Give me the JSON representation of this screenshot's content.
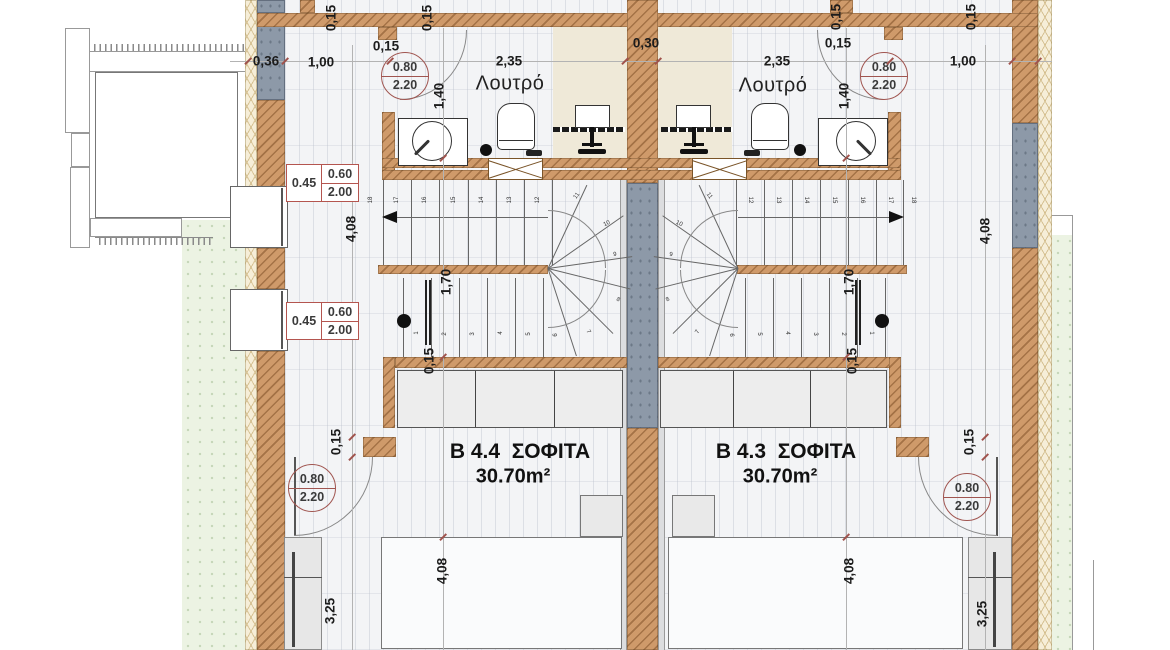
{
  "palette": {
    "wall_brown": "#cf9a6a",
    "wall_gray": "#8d99a8",
    "insulation": "#f6eed8",
    "floor": "#f3f4f6",
    "green": "#ecf3e3",
    "tag_red": "#a05550",
    "text": "#1c1c1c"
  },
  "rooms": [
    {
      "name": "B 4.4  ΣΟΦΙΤΑ",
      "area": "30.70m²"
    },
    {
      "name": "B 4.3  ΣΟΦΙΤΑ",
      "area": "30.70m²"
    }
  ],
  "bath_labels": [
    "Λουτρό",
    "Λουτρό"
  ],
  "dimensions": [
    {
      "text": "0,36",
      "x": 266,
      "y": 61,
      "rot": 0
    },
    {
      "text": "1,00",
      "x": 321,
      "y": 62,
      "rot": 0
    },
    {
      "text": "0,15",
      "x": 386,
      "y": 46,
      "rot": 0
    },
    {
      "text": "2,35",
      "x": 509,
      "y": 61,
      "rot": 0
    },
    {
      "text": "0,30",
      "x": 646,
      "y": 43,
      "rot": 0
    },
    {
      "text": "2,35",
      "x": 777,
      "y": 61,
      "rot": 0
    },
    {
      "text": "0,15",
      "x": 838,
      "y": 43,
      "rot": 0
    },
    {
      "text": "1,00",
      "x": 963,
      "y": 61,
      "rot": 0
    },
    {
      "text": "0,15",
      "x": 331,
      "y": 18,
      "rot": -90
    },
    {
      "text": "0,15",
      "x": 427,
      "y": 18,
      "rot": -90
    },
    {
      "text": "0,15",
      "x": 836,
      "y": 17,
      "rot": -90
    },
    {
      "text": "0,15",
      "x": 971,
      "y": 17,
      "rot": -90
    },
    {
      "text": "1,40",
      "x": 439,
      "y": 96,
      "rot": -90
    },
    {
      "text": "1,40",
      "x": 844,
      "y": 96,
      "rot": -90
    },
    {
      "text": "4,08",
      "x": 351,
      "y": 229,
      "rot": -90
    },
    {
      "text": "4,08",
      "x": 985,
      "y": 231,
      "rot": -90
    },
    {
      "text": "1,70",
      "x": 446,
      "y": 282,
      "rot": -90
    },
    {
      "text": "1,70",
      "x": 849,
      "y": 282,
      "rot": -90
    },
    {
      "text": "0,15",
      "x": 429,
      "y": 361,
      "rot": -90
    },
    {
      "text": "0,15",
      "x": 852,
      "y": 361,
      "rot": -90
    },
    {
      "text": "0,15",
      "x": 336,
      "y": 442,
      "rot": -90
    },
    {
      "text": "0,15",
      "x": 969,
      "y": 442,
      "rot": -90
    },
    {
      "text": "3,25",
      "x": 330,
      "y": 611,
      "rot": -90
    },
    {
      "text": "3,25",
      "x": 982,
      "y": 614,
      "rot": -90
    },
    {
      "text": "4,08",
      "x": 442,
      "y": 571,
      "rot": -90
    },
    {
      "text": "4,08",
      "x": 849,
      "y": 571,
      "rot": -90
    }
  ],
  "door_tags": [
    {
      "width": "0.80",
      "height": "2.20",
      "cx": 405,
      "cy": 76
    },
    {
      "width": "0.80",
      "height": "2.20",
      "cx": 884,
      "cy": 76
    },
    {
      "width": "0.80",
      "height": "2.20",
      "cx": 312,
      "cy": 488
    },
    {
      "width": "0.80",
      "height": "2.20",
      "cx": 967,
      "cy": 497
    }
  ],
  "window_tags": [
    {
      "sill": "0.45",
      "width": "0.60",
      "height": "2.00",
      "x": 286,
      "y": 164
    },
    {
      "sill": "0.45",
      "width": "0.60",
      "height": "2.00",
      "x": 286,
      "y": 302
    }
  ],
  "stair_numbers": [
    {
      "n": "18",
      "x": 371,
      "y": 200,
      "rot": -90
    },
    {
      "n": "17",
      "x": 397,
      "y": 200,
      "rot": -90
    },
    {
      "n": "16",
      "x": 425,
      "y": 200,
      "rot": -90
    },
    {
      "n": "15",
      "x": 454,
      "y": 200,
      "rot": -90
    },
    {
      "n": "14",
      "x": 482,
      "y": 200,
      "rot": -90
    },
    {
      "n": "13",
      "x": 510,
      "y": 200,
      "rot": -90
    },
    {
      "n": "12",
      "x": 538,
      "y": 200,
      "rot": -90
    },
    {
      "n": "11",
      "x": 577,
      "y": 196,
      "rot": -55
    },
    {
      "n": "10",
      "x": 607,
      "y": 224,
      "rot": -25
    },
    {
      "n": "9",
      "x": 615,
      "y": 255,
      "rot": -5
    },
    {
      "n": "8",
      "x": 618,
      "y": 300,
      "rot": 28
    },
    {
      "n": "7",
      "x": 588,
      "y": 332,
      "rot": 60
    },
    {
      "n": "6",
      "x": 556,
      "y": 335,
      "rot": -90
    },
    {
      "n": "5",
      "x": 529,
      "y": 334,
      "rot": -90
    },
    {
      "n": "4",
      "x": 501,
      "y": 333,
      "rot": -90
    },
    {
      "n": "3",
      "x": 473,
      "y": 334,
      "rot": -90
    },
    {
      "n": "2",
      "x": 445,
      "y": 334,
      "rot": -90
    },
    {
      "n": "1",
      "x": 417,
      "y": 333,
      "rot": -90
    },
    {
      "n": "12",
      "x": 750,
      "y": 200,
      "rot": 90
    },
    {
      "n": "13",
      "x": 778,
      "y": 200,
      "rot": 90
    },
    {
      "n": "14",
      "x": 806,
      "y": 200,
      "rot": 90
    },
    {
      "n": "15",
      "x": 834,
      "y": 200,
      "rot": 90
    },
    {
      "n": "16",
      "x": 862,
      "y": 200,
      "rot": 90
    },
    {
      "n": "17",
      "x": 890,
      "y": 200,
      "rot": 90
    },
    {
      "n": "18",
      "x": 913,
      "y": 200,
      "rot": 90
    },
    {
      "n": "11",
      "x": 709,
      "y": 196,
      "rot": 55
    },
    {
      "n": "10",
      "x": 679,
      "y": 224,
      "rot": 25
    },
    {
      "n": "9",
      "x": 671,
      "y": 255,
      "rot": 5
    },
    {
      "n": "8",
      "x": 668,
      "y": 300,
      "rot": -28
    },
    {
      "n": "7",
      "x": 698,
      "y": 332,
      "rot": -60
    },
    {
      "n": "6",
      "x": 731,
      "y": 335,
      "rot": 90
    },
    {
      "n": "5",
      "x": 759,
      "y": 334,
      "rot": 90
    },
    {
      "n": "4",
      "x": 787,
      "y": 333,
      "rot": 90
    },
    {
      "n": "3",
      "x": 815,
      "y": 334,
      "rot": 90
    },
    {
      "n": "2",
      "x": 843,
      "y": 334,
      "rot": 90
    },
    {
      "n": "1",
      "x": 871,
      "y": 333,
      "rot": 90
    }
  ],
  "ticks": [
    [
      248,
      61
    ],
    [
      285,
      61
    ],
    [
      390,
      61
    ],
    [
      625,
      61
    ],
    [
      658,
      61
    ],
    [
      890,
      61
    ],
    [
      1012,
      61
    ],
    [
      1038,
      61
    ],
    [
      352,
      437
    ],
    [
      352,
      457
    ],
    [
      985,
      437
    ],
    [
      985,
      457
    ],
    [
      443,
      158
    ],
    [
      443,
      357
    ],
    [
      443,
      537
    ],
    [
      846,
      158
    ],
    [
      846,
      357
    ],
    [
      846,
      537
    ]
  ]
}
